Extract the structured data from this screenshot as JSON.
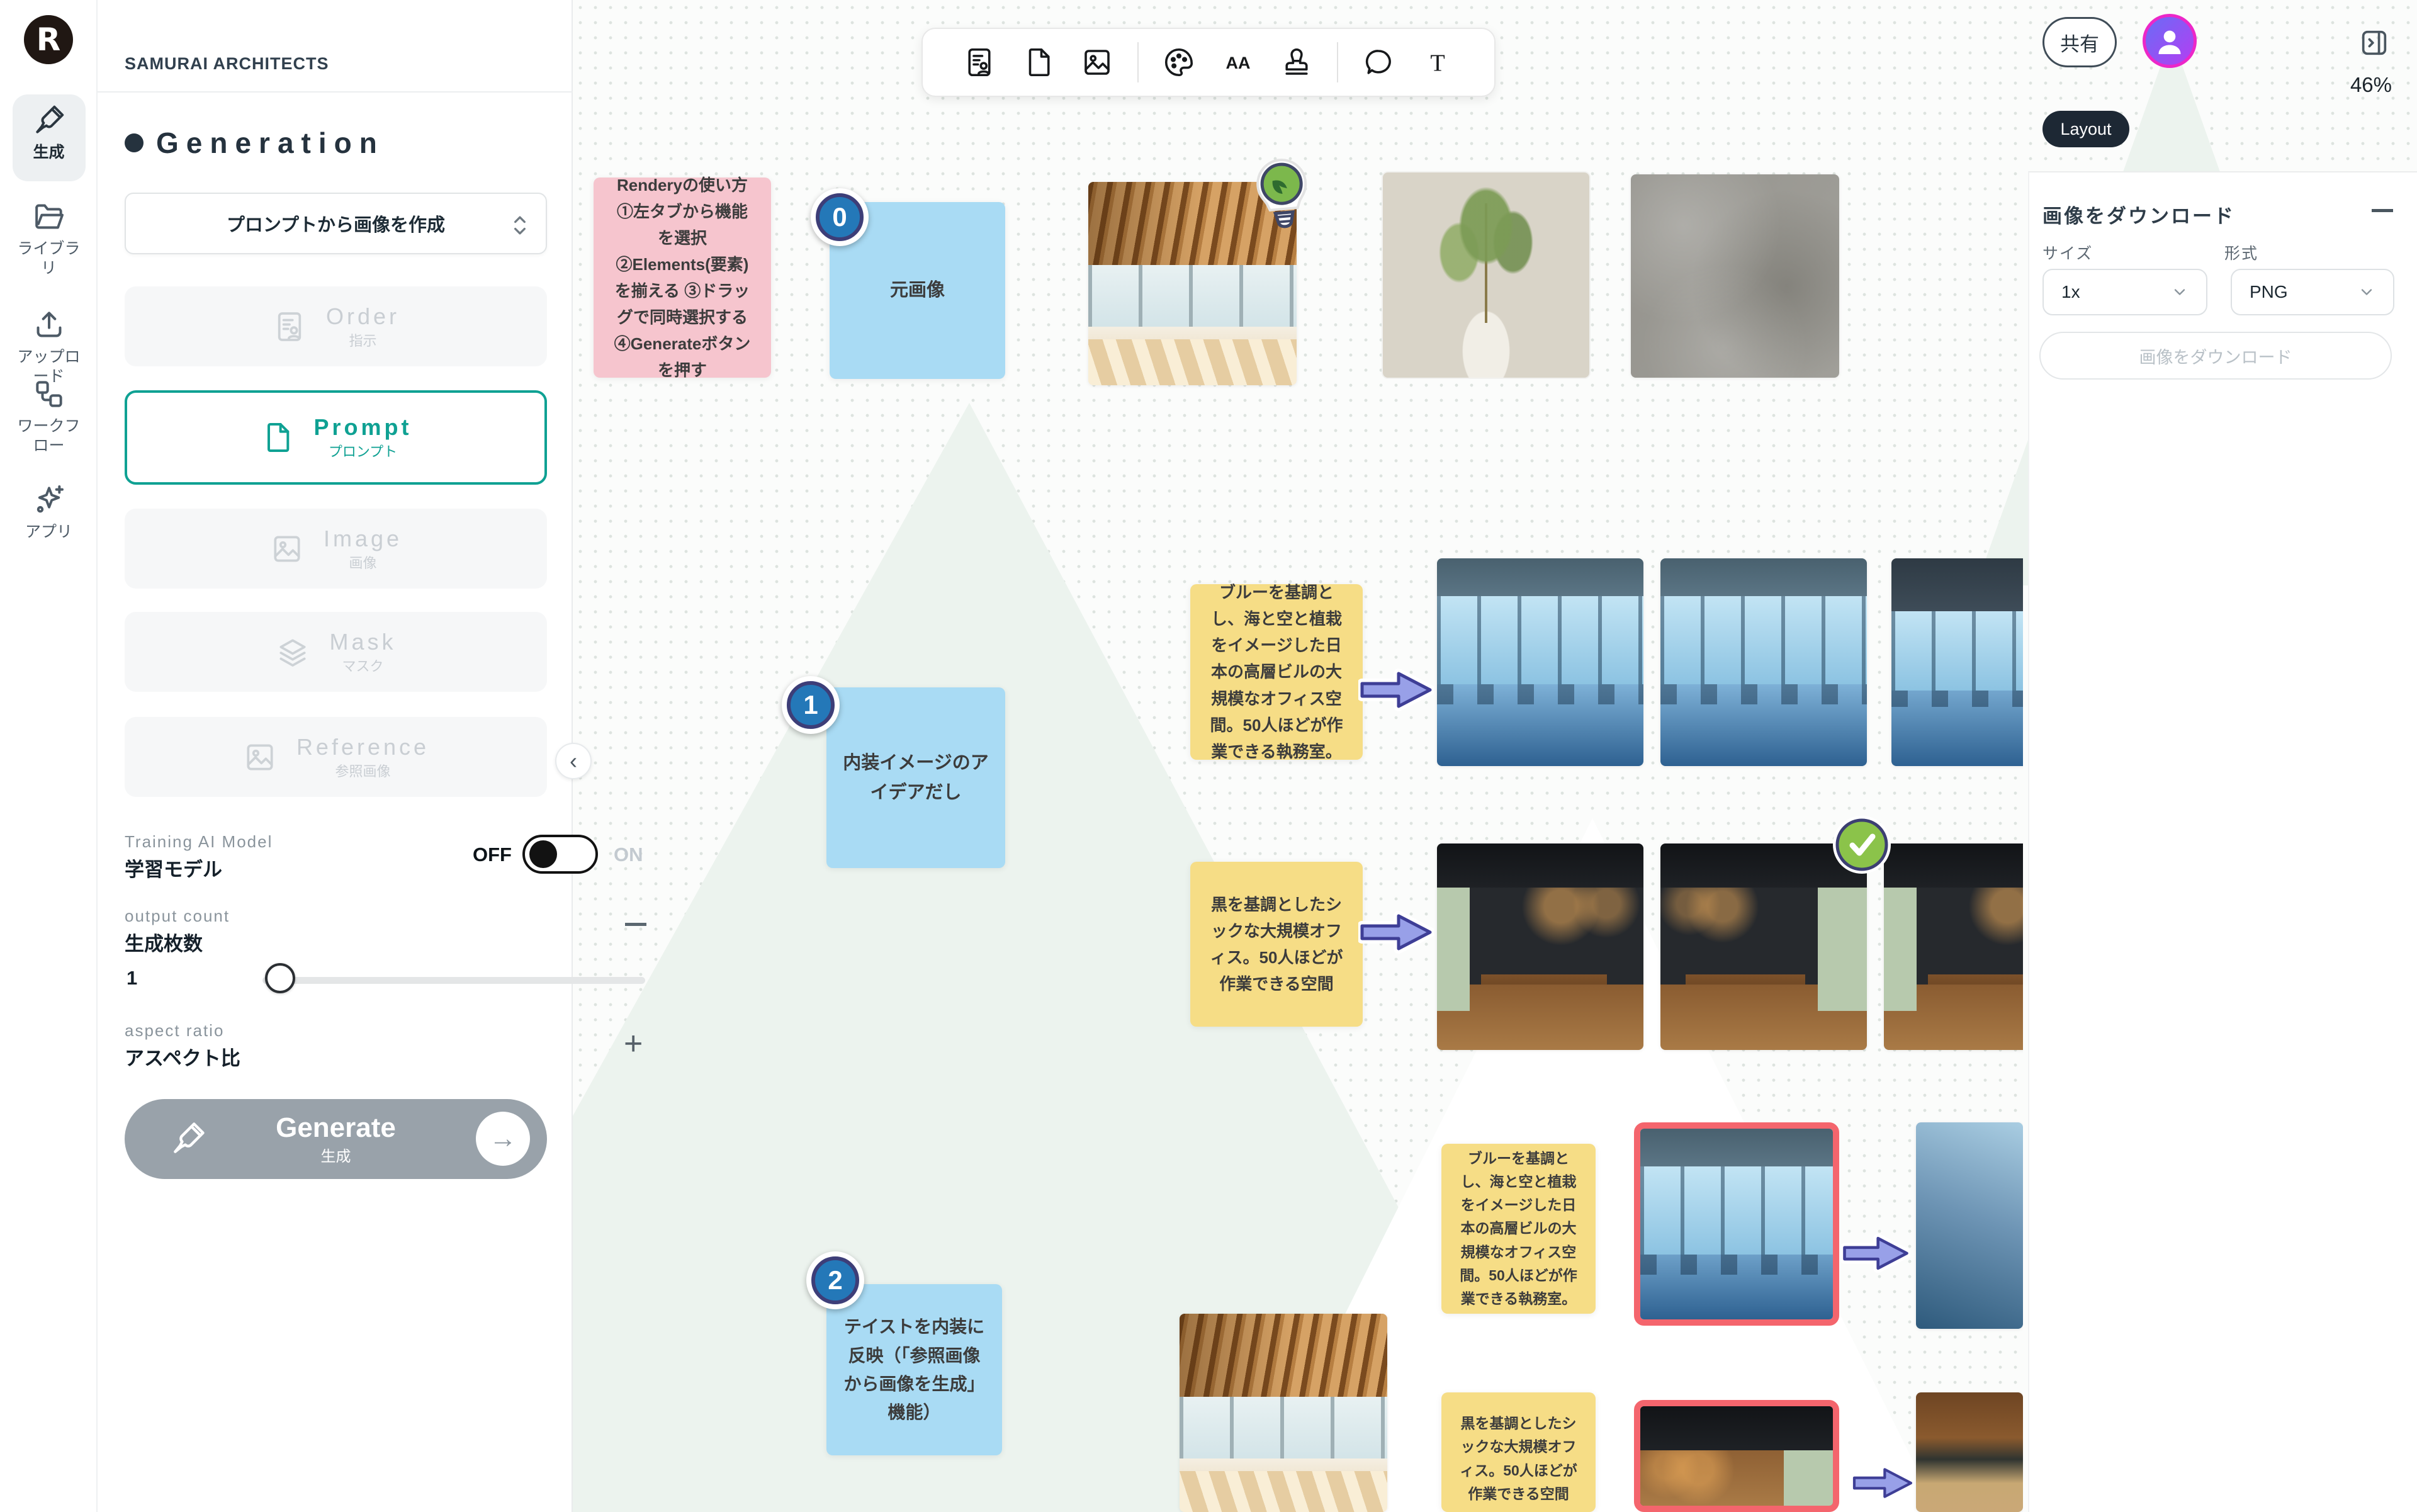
{
  "brand": {
    "logo_letter": "R",
    "workspace": "SAMURAI ARCHITECTS"
  },
  "nav_rail": {
    "items": [
      {
        "label": "生成",
        "icon": "brush-icon",
        "active": true
      },
      {
        "label": "ライブラリ",
        "icon": "folder-icon",
        "active": false
      },
      {
        "label": "アップロード",
        "icon": "upload-icon",
        "active": false
      },
      {
        "label": "ワークフロー",
        "icon": "workflow-icon",
        "active": false
      },
      {
        "label": "アプリ",
        "icon": "sparkles-icon",
        "active": false
      }
    ]
  },
  "sidebar": {
    "title": "Generation",
    "mode_select": {
      "value": "プロンプトから画像を作成"
    },
    "element_buttons": [
      {
        "en": "Order",
        "ja": "指示",
        "state": "disabled",
        "icon": "order-doc-icon"
      },
      {
        "en": "Prompt",
        "ja": "プロンプト",
        "state": "active",
        "icon": "file-icon"
      },
      {
        "en": "Image",
        "ja": "画像",
        "state": "disabled",
        "icon": "image-icon"
      },
      {
        "en": "Mask",
        "ja": "マスク",
        "state": "disabled",
        "icon": "layers-icon"
      },
      {
        "en": "Reference",
        "ja": "参照画像",
        "state": "disabled",
        "icon": "image-icon"
      }
    ],
    "training_model": {
      "label_en": "Training AI Model",
      "label_ja": "学習モデル",
      "off": "OFF",
      "on": "ON",
      "value": "OFF"
    },
    "output_count": {
      "label_en": "output count",
      "label_ja": "生成枚数",
      "value": "1"
    },
    "aspect_ratio": {
      "label_en": "aspect ratio",
      "label_ja": "アスペクト比"
    },
    "generate": {
      "en": "Generate",
      "ja": "生成"
    }
  },
  "toolbar": {
    "icons": [
      "order-template",
      "document",
      "image",
      "palette",
      "font",
      "stamp",
      "comment",
      "text"
    ]
  },
  "topbar": {
    "share": "共有",
    "zoom": "46%",
    "layout_badge": "Layout"
  },
  "download_panel": {
    "title": "画像をダウンロード",
    "size_label": "サイズ",
    "size_value": "1x",
    "format_label": "形式",
    "format_value": "PNG",
    "button": "画像をダウンロード"
  },
  "canvas": {
    "notes": {
      "howto": "Renderyの使い方 ①左タブから機能を選択 ②Elements(要素)を揃える ③ドラッグで同時選択する ④Generateボタンを押す",
      "step0": "元画像",
      "step1": "内装イメージのアイデアだし",
      "step2": "テイストを内装に反映（「参照画像から画像を生成」機能）",
      "prompt_blue": "ブルーを基調とし、海と空と植栽をイメージした日本の高層ビルの大規模なオフィス空間。50人ほどが作業できる執務室。",
      "prompt_black": "黒を基調としたシックな大規模オフィス。50人ほどが作業できる空間"
    },
    "badges": [
      "0",
      "1",
      "2"
    ]
  }
}
